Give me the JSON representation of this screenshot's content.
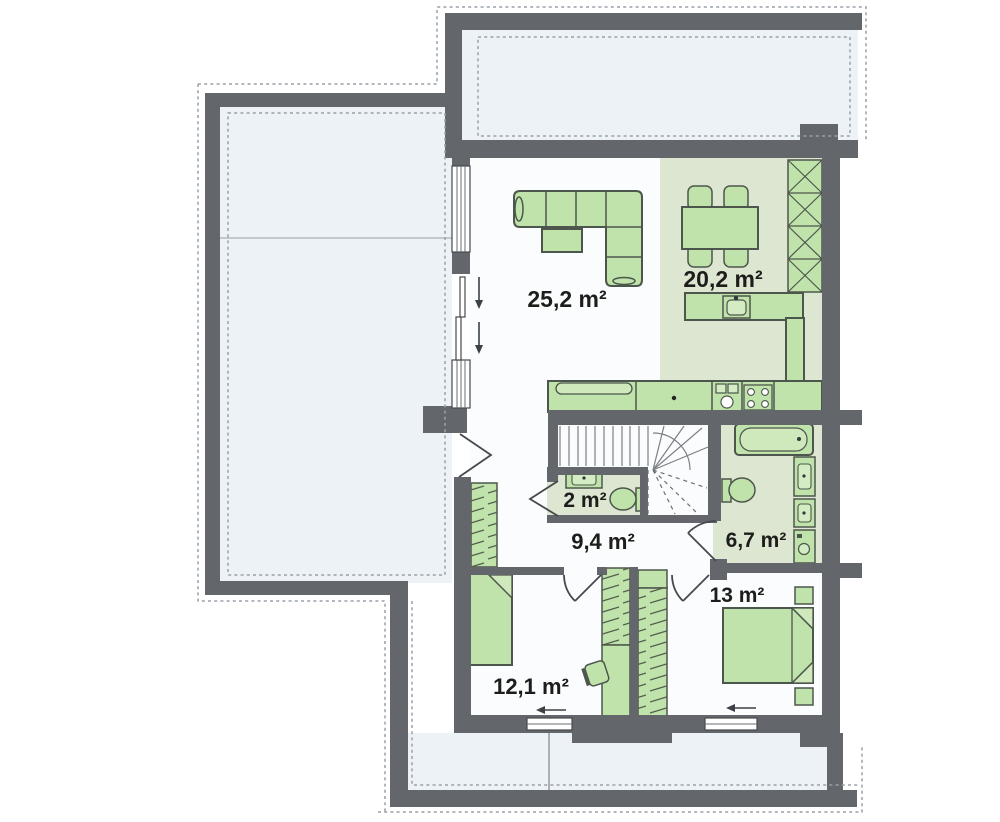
{
  "floor_plan": {
    "type": "architectural-floor-plan",
    "rooms": [
      {
        "id": "living-room",
        "area": "25,2 m²"
      },
      {
        "id": "kitchen-dining",
        "area": "20,2 m²"
      },
      {
        "id": "wc",
        "area": "2 m²"
      },
      {
        "id": "hall",
        "area": "9,4 m²"
      },
      {
        "id": "bathroom",
        "area": "6,7 m²"
      },
      {
        "id": "bedroom-right",
        "area": "13 m²"
      },
      {
        "id": "bedroom-left",
        "area": "12,1 m²"
      }
    ],
    "furniture": [
      "corner-sofa",
      "coffee-table",
      "dining-table",
      "dining-chairs",
      "kitchen-island-sink",
      "kitchen-counter",
      "kitchen-sink",
      "stove",
      "tall-cabinet",
      "stairs",
      "wc-sink",
      "wc-toilet",
      "bathtub",
      "toilet",
      "bathroom-sinks",
      "washing-machine",
      "wardrobes",
      "desk",
      "desk-chair",
      "single-bed",
      "double-bed",
      "nightstands"
    ],
    "colors": {
      "wall": "#63676c",
      "furniture_fill": "#bfe3ab",
      "furniture_outline": "#4d564c",
      "tinted_floor": "#dde6d1",
      "terrace_floor": "#edf2f6",
      "interior_floor": "#fbfcfe",
      "dashed_outline": "#9aa1a8",
      "label_text": "#1d1d1b"
    }
  }
}
